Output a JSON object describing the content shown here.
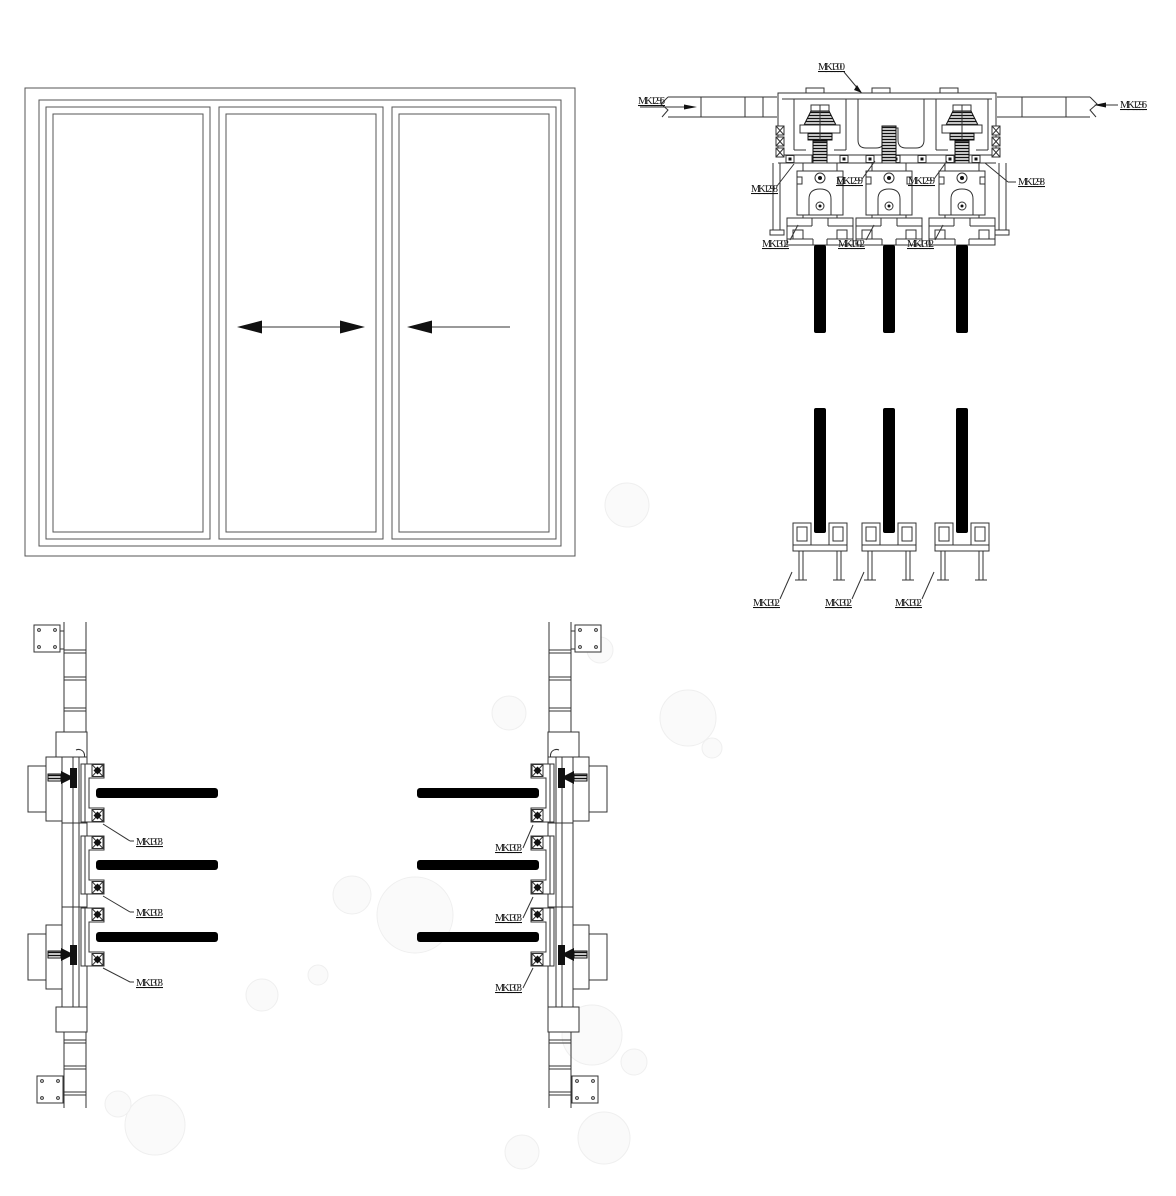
{
  "labels": {
    "head_section": {
      "track": "MK1300",
      "frame_left": "MK1296",
      "frame_right": "MK1296",
      "hanger_left": "MK1298",
      "hanger_right": "MK1298",
      "guide_left": "MK1299",
      "guide_right": "MK1299",
      "rail_mid": [
        "MK1302",
        "MK1302",
        "MK1302"
      ],
      "rail_bottom": [
        "MK1302",
        "MK1302",
        "MK1302"
      ]
    },
    "jamb_sections": {
      "left": [
        "MK1303",
        "MK1303",
        "MK1303"
      ],
      "right": [
        "MK1303",
        "MK1303",
        "MK1303"
      ]
    }
  },
  "colors": {
    "line": "#333333",
    "glass": "#000000",
    "background": "#ffffff",
    "watermark": "#efefef"
  }
}
